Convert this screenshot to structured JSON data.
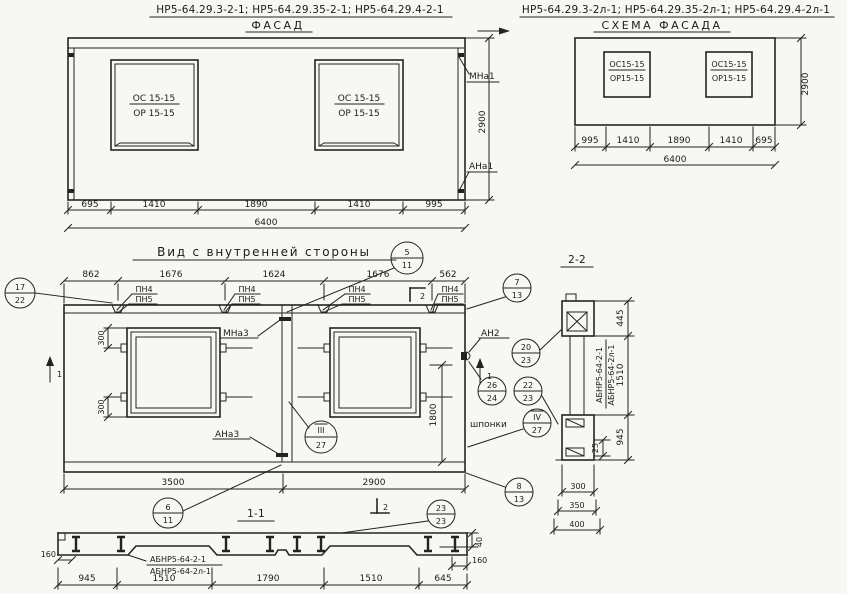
{
  "facade": {
    "codes": "НР5-64.29.3-2-1; НР5-64.29.35-2-1; НР5-64.29.4-2-1",
    "title": "ФАСАД",
    "window_top": "ОС 15-15",
    "window_bottom": "ОР 15-15",
    "dims_bottom": [
      "695",
      "1410",
      "1890",
      "1410",
      "995"
    ],
    "dim_total": "6400",
    "dim_height": "2900",
    "anchor_top": "МНа1",
    "anchor_bottom": "АНа1"
  },
  "schema": {
    "codes": "НР5-64.29.3-2л-1; НР5-64.29.35-2л-1; НР5-64.29.4-2л-1",
    "title": "СХЕМА ФАСАДА",
    "window_top": "ОС15-15",
    "window_bottom": "ОР15-15",
    "dims_bottom": [
      "995",
      "1410",
      "1890",
      "1410",
      "695"
    ],
    "dim_total": "6400",
    "dim_height": "2900"
  },
  "inner": {
    "title": "Вид с внутренней стороны",
    "dims_top": [
      "862",
      "1676",
      "1624",
      "1676",
      "562"
    ],
    "pn_top": "ПН4",
    "pn_bottom": "ПН5",
    "labels": {
      "mna3": "МНа3",
      "ana3": "АНа3",
      "an2": "АН2",
      "shponki": "шпонки"
    },
    "dims": {
      "d300": "300",
      "d1800": "1800",
      "d3500": "3500",
      "d2900": "2900"
    },
    "marker1": "1",
    "marker2": "2",
    "callouts": {
      "c17_22": {
        "top": "17",
        "bottom": "22"
      },
      "c5_11": {
        "top": "5",
        "bottom": "11"
      },
      "c7_13": {
        "top": "7",
        "bottom": "13"
      },
      "c8_13": {
        "top": "8",
        "bottom": "13"
      },
      "c20_23": {
        "top": "20",
        "bottom": "23"
      },
      "c26_24": {
        "top": "26",
        "bottom": "24"
      },
      "c22_23": {
        "top": "22",
        "bottom": "23"
      },
      "c4_27": {
        "top": "IV",
        "bottom": "27"
      },
      "c3_27": {
        "top": "III",
        "bottom": "27"
      },
      "c6_11": {
        "top": "6",
        "bottom": "11"
      },
      "c23_23": {
        "top": "23",
        "bottom": "23"
      }
    }
  },
  "section22": {
    "title": "2-2",
    "dim_445": "445",
    "dim_1510": "1510",
    "dim_945": "945",
    "dim_25": "25",
    "dims_width": [
      "300",
      "350",
      "400"
    ],
    "label_a": "АБНР5-64-2-1",
    "label_b": "АБНР5-64-2л-1"
  },
  "section11": {
    "title": "1-1",
    "label_a": "АБНР5-64-2-1",
    "label_b": "АБНР5-64-2л-1",
    "dim_160_left": "160",
    "dim_40": "40",
    "dim_160_right": "160",
    "dims_bottom": [
      "945",
      "1510",
      "1790",
      "1510",
      "645"
    ]
  }
}
